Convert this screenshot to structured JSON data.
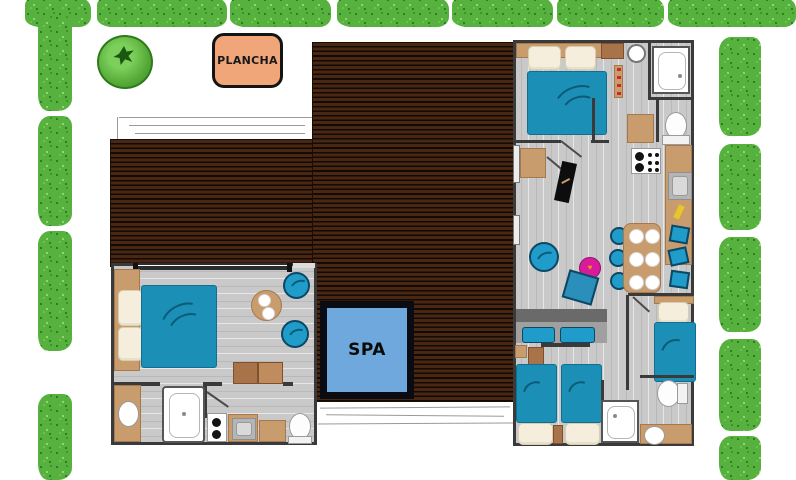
{
  "labels": {
    "plancha": "PLANCHA",
    "spa": "SPA"
  },
  "colors": {
    "deck_dark": "#120a04",
    "deck_brown": "#4a2712",
    "hedge_base": "#57b13f",
    "hedge_dark": "#2f7d1f",
    "hedge_light": "#8fd96a",
    "tree_outline": "#2e7a1c",
    "wall": "#3a3a3a",
    "floor": "#c9c9c9",
    "wood_tan": "#c99c6d",
    "wood_brown": "#a9734a",
    "mattress_blue": "#1b8fb5",
    "mattress_stroke": "#0c5a78",
    "chair_blue": "#1f9cc9",
    "chair_stroke": "#0d4763",
    "pillow_cream": "#f5eedc",
    "pouf_pink": "#d81b9b",
    "spa_fill": "#6fa8dc",
    "spa_border": "#0b0b14",
    "plancha_fill": "#f0a679",
    "sofa_dark": "#6a6a6a",
    "sofa_light": "#a0a0a0",
    "steel": "#b5b5b5",
    "accent_yellow": "#e8c62a"
  },
  "landscape": {
    "tree": "round-shrub",
    "hedge_top_clumps": 7,
    "hedge_left_segments": 4,
    "hedge_right_segments": 5
  },
  "deck": {
    "spa_units": 1,
    "plancha_units": 1
  },
  "units": {
    "left_unit": {
      "furniture": [
        "double-bed",
        "round-table",
        "chairs",
        "wardrobe",
        "washbasin",
        "bathtub",
        "stove",
        "kitchen-sink",
        "cabinet",
        "toilet",
        "window"
      ]
    },
    "right_unit": {
      "furniture": [
        "double-bed",
        "wardrobe",
        "clock",
        "shelf",
        "shower",
        "vanity",
        "toilet",
        "stove",
        "kitchen-counter",
        "kitchen-sink",
        "fridge-cabinet",
        "tv-unit",
        "dining-table",
        "dining-chairs",
        "bar-stools",
        "armchair",
        "pouf",
        "coffee-table",
        "sofa",
        "twin-beds",
        "single-bed",
        "shower",
        "toilet",
        "washbasin"
      ]
    }
  }
}
